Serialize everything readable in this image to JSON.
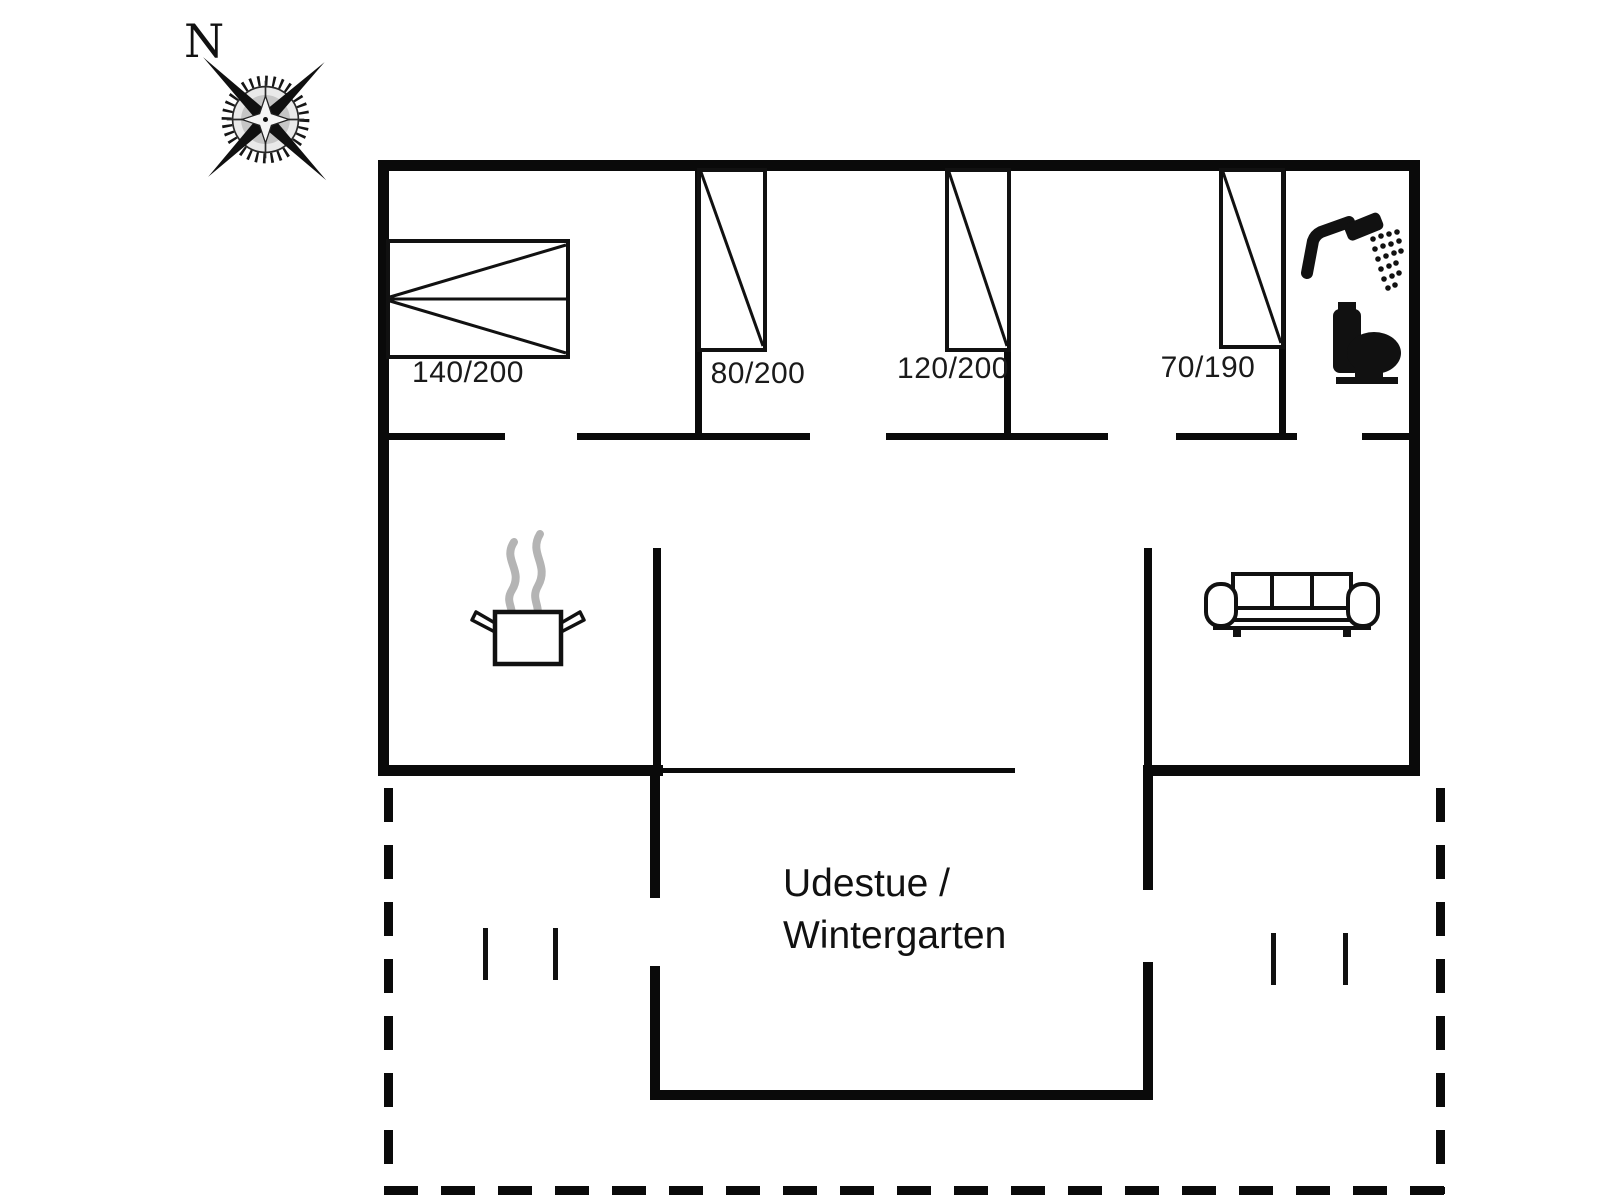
{
  "compass": {
    "north_label": "N"
  },
  "beds": {
    "double_bed_label": "140/200",
    "single_bed_80_label": "80/200",
    "single_bed_120_label": "120/200",
    "single_bed_70_label": "70/190"
  },
  "rooms": {
    "wintergarten_line1": "Udestue /",
    "wintergarten_line2": "Wintergarten"
  },
  "icons": {
    "compass_rose": "compass-rose-icon",
    "shower": "shower-icon",
    "toilet": "toilet-icon",
    "cooking_pot": "cooking-pot-icon",
    "sofa": "sofa-icon"
  },
  "colors": {
    "wall": "#0a0a0a",
    "text": "#1a1a1a",
    "steam": "#b4b4b4",
    "background": "#ffffff"
  }
}
